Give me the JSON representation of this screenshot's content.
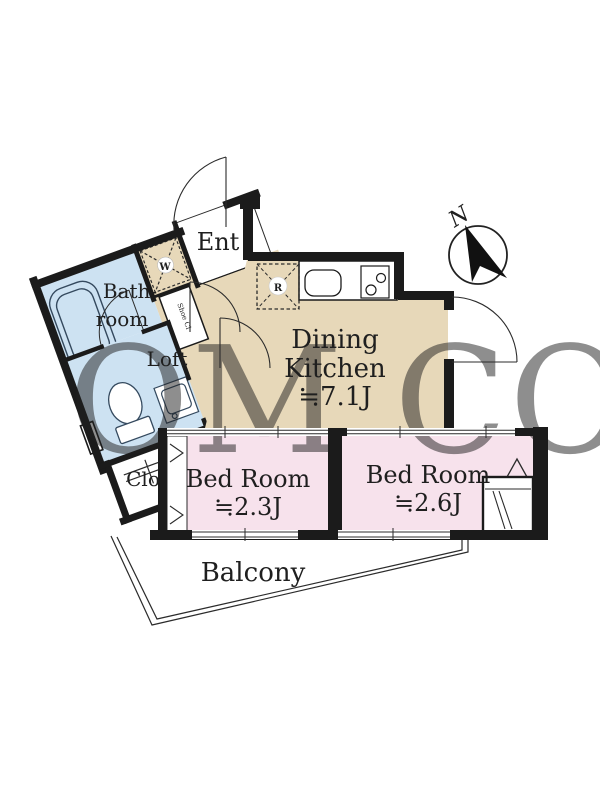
{
  "rooms": {
    "entrance": {
      "label": "Ent"
    },
    "washer": {
      "label": "W"
    },
    "shoe_closet": {
      "label": "Shoe Cl"
    },
    "bathroom": {
      "label_line1": "Bath-",
      "label_line2": "room"
    },
    "loft": {
      "label": "Loft"
    },
    "closet": {
      "label": "Clo"
    },
    "dining_kitchen": {
      "label_line1": "Dining",
      "label_line2": "Kitchen",
      "area": "≒7.1J"
    },
    "refrigerator": {
      "label": "R"
    },
    "bedroom_1": {
      "label": "Bed Room",
      "area": "≒2.3J"
    },
    "bedroom_2": {
      "label": "Bed Room",
      "area": "≒2.6J"
    },
    "balcony": {
      "label": "Balcony"
    }
  },
  "compass": {
    "label": "N"
  },
  "watermark": {
    "text": "OM CO"
  },
  "colors": {
    "wall": "#1b1b1b",
    "line": "#2b2b2b",
    "kitchen_floor": "#e7d8b9",
    "bedroom_floor": "#f7e2ec",
    "bath_floor": "#cde2f2",
    "watermark": "#ddd3bf"
  }
}
